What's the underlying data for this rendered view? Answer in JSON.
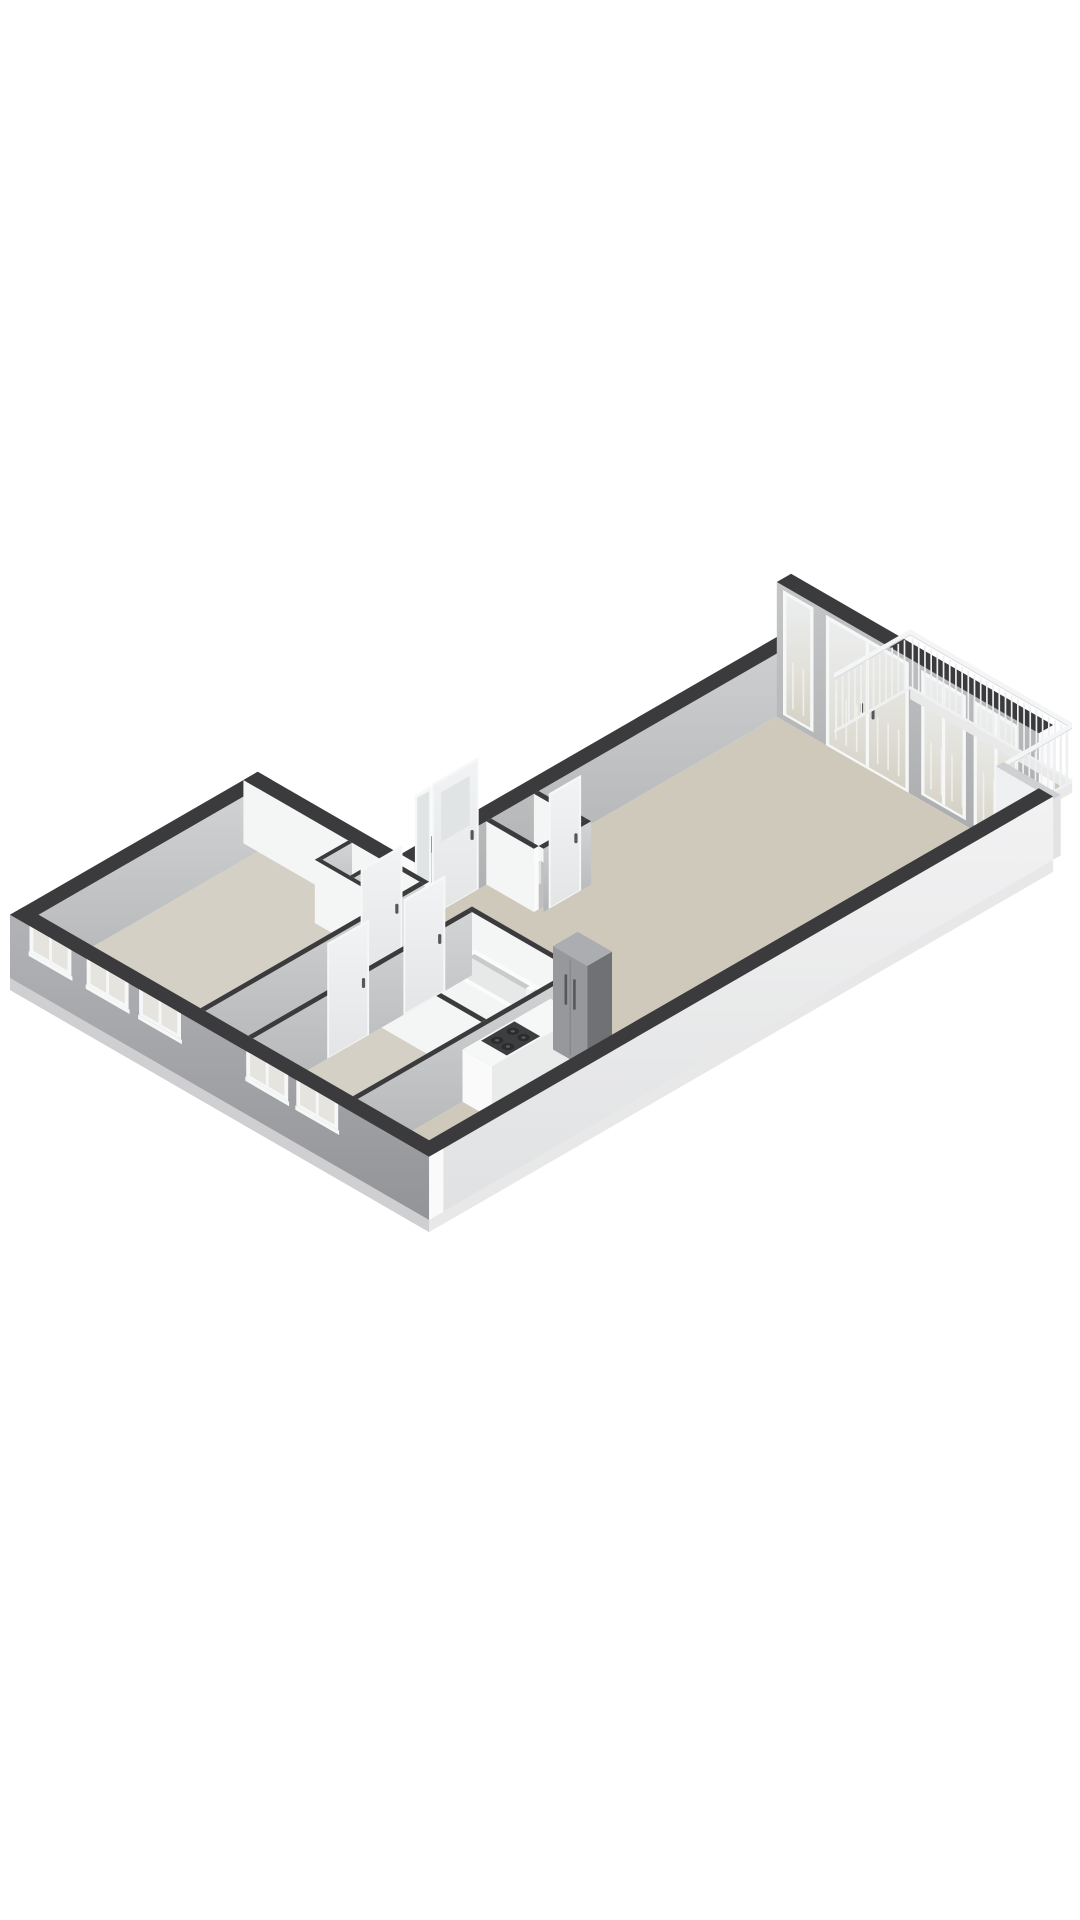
{
  "meta": {
    "description": "3D isometric floor plan rendering of an apartment on a white background. Bedroom wing with five facade windows at lower left, entry with full-height glazed front door, bathroom with bathtub, kitchen with counter, gas hob and tall fridge, long living room leading to a balcony with white railing at the upper right.",
    "type": "3d-floorplan-render"
  },
  "projection": {
    "scale": 55,
    "ox": 10,
    "oy": 978,
    "cos": 0.866,
    "sin": 0.5
  },
  "palette": {
    "cap": "#3b3b3d",
    "intSW": "#f4f5f5",
    "endcut": "#fafafa",
    "gIntSE": "url(#gIntSE)",
    "gNWwall": "url(#gNWwall)",
    "gExtSW": "url(#gExtSW)",
    "gExtSE": "url(#gExtSE)",
    "gFrench": "url(#gFrench)",
    "gDoor": "url(#gDoor)",
    "gGlassTall": "url(#gGlassTall)",
    "floorBeige": "#d5d0c6",
    "floorLiving": "#cfc9bc",
    "floorLight": "#e7e5e1",
    "floorBath": "#e4e2de",
    "floorGray": "#c0c0c1",
    "floorBalcony": "#cec8bb",
    "threshold": "#efeeec",
    "slabSW": "#cfcfd1",
    "slabSE": "#e8e8e9",
    "fascia": "#e9e9ea",
    "frame": "#f6f7f7",
    "glassSmall": "#e6e4df",
    "railing": "#eff0f1",
    "railTop": "#f4f5f6",
    "railShadow": "#d9dadb",
    "stubSW": "#eff0f1",
    "stubSE": "#e2e3e4",
    "stubTop": "#cfd0d1",
    "counterTop": "#f6f7f7",
    "counterFront": "#e9ebeb",
    "counterEnd": "#fafafa",
    "stoveTop": "#3d3e40",
    "burner": "#2b2c2e",
    "burnerCap": "#5a5c5e",
    "fridgeFront": "#96989c",
    "fridgeSide": "#6f7174",
    "fridgeTop": "#abadb0",
    "fridgeSeam": "#7d7f83",
    "handle": "#55575a",
    "tubSide": "#f3f4f4",
    "tubEnd": "#e0e1e2",
    "tubRim": "#fafbfb",
    "tubInner": "#e7e9e9",
    "tubInnerShadow": "#c8cacb",
    "fixture": "#f1f2f2",
    "glassPale": "#e0e4e5"
  },
  "floors": [
    {
      "name": "floor-bedroom-1",
      "rect": [
        0.3,
        0.3,
        3.7,
        4.9
      ],
      "fill": "floorBeige"
    },
    {
      "name": "floor-closets",
      "rect": [
        2.28,
        4.28,
        3.7,
        4.9
      ],
      "fill": "floorGray"
    },
    {
      "name": "floor-corridor",
      "rect": [
        3.8,
        0.3,
        4.7,
        4.9
      ],
      "fill": "floorLight"
    },
    {
      "name": "floor-bedroom-2",
      "rect": [
        4.8,
        0.3,
        6.9,
        3.0
      ],
      "fill": "floorBeige"
    },
    {
      "name": "floor-bathroom",
      "rect": [
        4.8,
        3.1,
        6.9,
        4.9
      ],
      "fill": "floorBath"
    },
    {
      "name": "floor-kitchen",
      "rect": [
        7.0,
        0.3,
        8.5,
        4.9
      ],
      "fill": "floorLiving"
    },
    {
      "name": "floor-living-room",
      "rect": [
        3.3,
        4.9,
        8.5,
        12.8
      ],
      "fill": "floorLiving"
    },
    {
      "name": "floor-toilet",
      "rect": [
        3.3,
        6.8,
        4.3,
        7.7
      ],
      "fill": "floorGray"
    },
    {
      "name": "floor-balcony",
      "rect": [
        4.2,
        13.1,
        7.6,
        14.7
      ],
      "fill": "floorBalcony"
    },
    {
      "name": "threshold-bed1",
      "rect": [
        3.7,
        3.6,
        3.8,
        4.4
      ],
      "fill": "threshold"
    },
    {
      "name": "threshold-bed2",
      "rect": [
        4.7,
        1.9,
        4.8,
        2.7
      ],
      "fill": "threshold"
    },
    {
      "name": "threshold-bath",
      "rect": [
        4.7,
        3.5,
        4.8,
        4.3
      ],
      "fill": "threshold"
    },
    {
      "name": "threshold-toilet",
      "rect": [
        4.3,
        6.95,
        4.4,
        7.55
      ],
      "fill": "threshold"
    },
    {
      "name": "threshold-entry",
      "rect": [
        3.0,
        5.6,
        3.3,
        6.5
      ],
      "fill": "threshold"
    },
    {
      "name": "threshold-balcony",
      "rect": [
        4.4,
        12.8,
        6.0,
        13.1
      ],
      "fill": "threshold"
    }
  ],
  "items": [
    {
      "type": "box",
      "name": "wall-west-end",
      "p0": 0,
      "p1": 0.3,
      "q0": 0,
      "q1": 5.2,
      "h": 1.15,
      "se": "gIntSE",
      "top": "cap"
    },
    {
      "type": "box",
      "name": "wall-bed1-northeast-ext",
      "p0": 0,
      "p1": 3.3,
      "q0": 4.9,
      "q1": 5.2,
      "h": 1.15,
      "sw": "intSW",
      "se": "endcut",
      "top": "cap"
    },
    {
      "type": "box",
      "name": "wall-northwest-ext",
      "p0": 3.0,
      "p1": 3.3,
      "q0": 5.2,
      "q1": 13.1,
      "h": 1.15,
      "sw": "endcut",
      "se": "gNWwall",
      "top": "cap"
    },
    {
      "type": "sidelight",
      "name": "entry-sidelight-window",
      "plane": "p",
      "at": 3.3,
      "a0": 5.25,
      "a1": 5.5,
      "z0": 0.15,
      "z1": 2.3
    },
    {
      "type": "doorLeaf",
      "name": "entry-door",
      "plane": "p",
      "at": 3.3,
      "a0": 5.6,
      "a1": 6.5,
      "h": 2.35,
      "glass": {
        "a0": 5.75,
        "a1": 6.35,
        "z0": 1.25,
        "z1": 2.15
      },
      "handleA": 6.4,
      "handleZ": 1.05
    },
    {
      "type": "box",
      "name": "wall-toilet-northeast",
      "p0": 3.3,
      "p1": 4.3,
      "q0": 7.7,
      "q1": 7.8,
      "h": 1.15,
      "sw": "intSW",
      "se": "endcut",
      "top": "cap"
    },
    {
      "type": "box",
      "name": "toilet-fixture",
      "p0": 3.45,
      "p1": 3.85,
      "q0": 6.95,
      "q1": 7.3,
      "h": 0.42,
      "sw": "fixture",
      "se": "tubEnd",
      "top": "tubRim"
    },
    {
      "type": "box",
      "name": "wall-toilet-southwest",
      "p0": 3.3,
      "p1": 4.3,
      "q0": 6.7,
      "q1": 6.8,
      "h": 1.15,
      "sw": "intSW",
      "se": "endcut",
      "top": "cap"
    },
    {
      "type": "box",
      "name": "wall-toilet-southeast",
      "p0": 4.3,
      "p1": 4.4,
      "q0": 6.8,
      "q1": 7.8,
      "h": 1.15,
      "se": "gIntSE",
      "top": "cap"
    },
    {
      "type": "doorLeaf",
      "name": "toilet-door",
      "plane": "p",
      "at": 4.4,
      "a0": 6.95,
      "a1": 7.55,
      "h": 2.05,
      "handleA": 7.48,
      "handleZ": 1.0
    },
    {
      "type": "box",
      "name": "wall-closet-back",
      "p0": 2.2,
      "p1": 2.28,
      "q0": 4.28,
      "q1": 4.9,
      "h": 1.15,
      "se": "gIntSE",
      "top": "cap"
    },
    {
      "type": "box",
      "name": "wall-closet-divider",
      "p0": 2.86,
      "p1": 2.94,
      "q0": 4.28,
      "q1": 4.9,
      "h": 1.15,
      "se": "gIntSE",
      "top": "cap"
    },
    {
      "type": "box",
      "name": "wall-closet-front",
      "p0": 2.2,
      "p1": 3.7,
      "q0": 4.2,
      "q1": 4.28,
      "h": 1.15,
      "sw": "intSW",
      "top": "cap"
    },
    {
      "type": "box",
      "name": "wall-living-partition-a",
      "p0": 3.0,
      "p1": 3.8,
      "q0": 4.9,
      "q1": 5.0,
      "h": 1.15,
      "sw": "intSW",
      "se": "endcut",
      "top": "cap"
    },
    {
      "type": "box",
      "name": "wall-bed1-southeast",
      "p0": 3.7,
      "p1": 3.8,
      "q0": 0.3,
      "q1": 4.9,
      "h": 1.15,
      "se": "gIntSE",
      "top": "cap"
    },
    {
      "type": "doorLeaf",
      "name": "bedroom1-door",
      "plane": "p",
      "at": 3.8,
      "a0": 3.6,
      "a1": 4.4,
      "h": 2.05,
      "handleA": 4.32,
      "handleZ": 1.0
    },
    {
      "type": "box",
      "name": "wall-bath-northeast",
      "p0": 4.7,
      "p1": 6.9,
      "q0": 4.9,
      "q1": 5.0,
      "h": 1.15,
      "sw": "intSW",
      "se": "endcut",
      "top": "cap"
    },
    {
      "type": "tub",
      "name": "bathtub",
      "p0": 4.9,
      "p1": 6.65,
      "q0": 4.15,
      "q1": 4.85,
      "h": 0.55
    },
    {
      "type": "box",
      "name": "bathtub-faucet",
      "p0": 6.38,
      "p1": 6.5,
      "q0": 4.45,
      "q1": 4.55,
      "h": 0.78,
      "sw": "fixture",
      "se": "tubEnd",
      "top": "tubRim"
    },
    {
      "type": "box",
      "name": "wall-bed2-bath-divider",
      "p0": 4.8,
      "p1": 6.9,
      "q0": 3.0,
      "q1": 3.1,
      "h": 1.15,
      "sw": "intSW",
      "se": "endcut",
      "top": "cap"
    },
    {
      "type": "box",
      "name": "wall-bed2-northwest",
      "p0": 4.7,
      "p1": 4.8,
      "q0": 0.3,
      "q1": 4.9,
      "h": 1.15,
      "se": "gIntSE",
      "top": "cap"
    },
    {
      "type": "doorLeaf",
      "name": "bedroom2-door",
      "plane": "p",
      "at": 4.8,
      "a0": 1.9,
      "a1": 2.7,
      "h": 2.05,
      "handleA": 2.62,
      "handleZ": 1.0
    },
    {
      "type": "doorLeaf",
      "name": "bathroom-door",
      "plane": "p",
      "at": 4.8,
      "a0": 3.5,
      "a1": 4.3,
      "h": 2.05,
      "handleA": 4.22,
      "handleZ": 1.0
    },
    {
      "type": "box",
      "name": "wall-kitchen-northwest",
      "p0": 6.9,
      "p1": 7.0,
      "q0": 0.3,
      "q1": 4.9,
      "h": 1.15,
      "se": "gIntSE",
      "top": "cap"
    },
    {
      "type": "box",
      "name": "kitchen-counter",
      "p0": 7.0,
      "p1": 7.62,
      "q0": 2.5,
      "q1": 4.35,
      "h": 0.95,
      "sw": "counterEnd",
      "se": "counterFront",
      "top": "counterTop"
    },
    {
      "type": "stove",
      "name": "kitchen-stove",
      "p0": 7.04,
      "p1": 7.58,
      "q0": 2.85,
      "q1": 3.55,
      "z": 0.955
    },
    {
      "type": "fridge",
      "name": "kitchen-fridge",
      "p0": 7.0,
      "p1": 7.72,
      "q0": 4.4,
      "q1": 4.92,
      "h": 1.88
    },
    {
      "type": "box",
      "name": "wall-living-balcony",
      "p0": 3.3,
      "p1": 8.8,
      "q0": 12.8,
      "q1": 13.1,
      "h": 2.45,
      "sw": "gFrench",
      "se": "endcut",
      "top": "cap"
    },
    {
      "type": "glazing",
      "name": "balcony-sidelight",
      "at": 12.8,
      "p0": 3.5,
      "p1": 4.0,
      "z0": 0.15,
      "z1": 2.3,
      "mullions": []
    },
    {
      "type": "glazing",
      "name": "balcony-french-doors",
      "at": 12.8,
      "p0": 4.4,
      "p1": 6.0,
      "z0": 0.05,
      "z1": 2.3,
      "mullions": [
        5.2
      ],
      "handles": [
        5.08,
        5.32
      ]
    },
    {
      "type": "glazing",
      "name": "balcony-window-a",
      "at": 12.8,
      "p0": 6.4,
      "p1": 7.2,
      "z0": 0.15,
      "z1": 2.3,
      "mullions": [
        6.8
      ]
    },
    {
      "type": "glazing",
      "name": "balcony-window-b",
      "at": 12.8,
      "p0": 7.5,
      "p1": 8.3,
      "z0": 0.15,
      "z1": 2.3,
      "mullions": [
        7.9
      ]
    },
    {
      "type": "railing",
      "name": "balcony-railing-northwest",
      "axis": "q",
      "at": 4.2,
      "a0": 13.1,
      "a1": 14.7,
      "h": 1.0,
      "step": 0.13
    },
    {
      "type": "railing",
      "name": "balcony-railing-northeast",
      "axis": "p",
      "at": 14.7,
      "a0": 4.2,
      "a1": 7.6,
      "h": 1.0,
      "step": 0.13,
      "fascia": true
    },
    {
      "type": "railing",
      "name": "balcony-railing-southeast",
      "axis": "q",
      "at": 7.6,
      "a0": 13.1,
      "a1": 14.7,
      "h": 1.0,
      "step": 0.13,
      "fascia": true
    },
    {
      "type": "box",
      "name": "balcony-side-wall",
      "p0": 7.6,
      "p1": 8.8,
      "q0": 13.1,
      "q1": 13.26,
      "h": 1.1,
      "sw": "stubSW",
      "se": "stubSE",
      "top": "stubTop"
    },
    {
      "type": "slab",
      "name": "slab-southeast",
      "plane": "p",
      "at": 8.8,
      "a0": 0,
      "a1": 13.1,
      "fill": "slabSE"
    },
    {
      "type": "box",
      "name": "wall-southeast-ext",
      "p0": 8.5,
      "p1": 8.8,
      "q0": 0,
      "q1": 13.1,
      "h": 1.15,
      "se": "gExtSE",
      "top": "cap"
    },
    {
      "type": "slab",
      "name": "slab-facade",
      "plane": "q",
      "at": 0,
      "a0": 0,
      "a1": 8.8,
      "fill": "slabSW"
    },
    {
      "type": "facadeWall",
      "name": "wall-facade-ext",
      "p0": 0,
      "p1": 8.8,
      "q0": 0,
      "q1": 0.3,
      "h": 1.15,
      "windows": [
        [
          0.45,
          1.25
        ],
        [
          1.65,
          2.45
        ],
        [
          2.75,
          3.55
        ],
        [
          5.0,
          5.8
        ],
        [
          6.05,
          6.85
        ]
      ]
    }
  ]
}
